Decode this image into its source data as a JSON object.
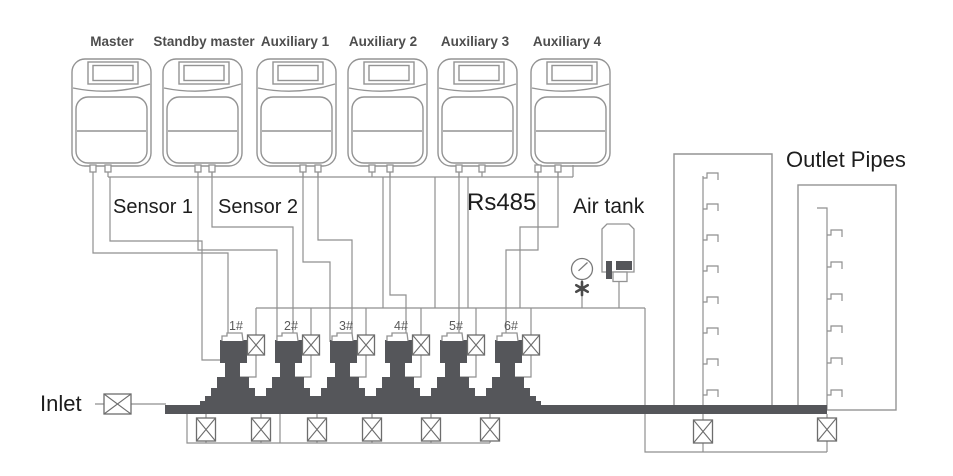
{
  "controllers": [
    {
      "label": "Master"
    },
    {
      "label": "Standby master"
    },
    {
      "label": "Auxiliary 1"
    },
    {
      "label": "Auxiliary 2"
    },
    {
      "label": "Auxiliary 3"
    },
    {
      "label": "Auxiliary 4"
    }
  ],
  "pumps": [
    {
      "id": "1#"
    },
    {
      "id": "2#"
    },
    {
      "id": "3#"
    },
    {
      "id": "4#"
    },
    {
      "id": "5#"
    },
    {
      "id": "6#"
    }
  ],
  "labels": {
    "sensor1": "Sensor 1",
    "sensor2": "Sensor 2",
    "bus": "Rs485",
    "air_tank": "Air tank",
    "outlet_pipes": "Outlet Pipes",
    "inlet": "Inlet"
  },
  "icons": {
    "valve": "crossed-box-valve",
    "gauge": "pressure-gauge",
    "gauge_valve": "asterisk-valve",
    "tank": "air-tank",
    "controller": "pump-controller-unit",
    "pump": "vertical-multistage-pump"
  },
  "colors": {
    "background": "#ffffff",
    "line": "#8f8f8f",
    "outline": "#939393",
    "dark_fill": "#55565a",
    "text_primary": "#1d1d1d",
    "text_secondary": "#4d4d4d",
    "pump_label": "#5a5a5a"
  }
}
